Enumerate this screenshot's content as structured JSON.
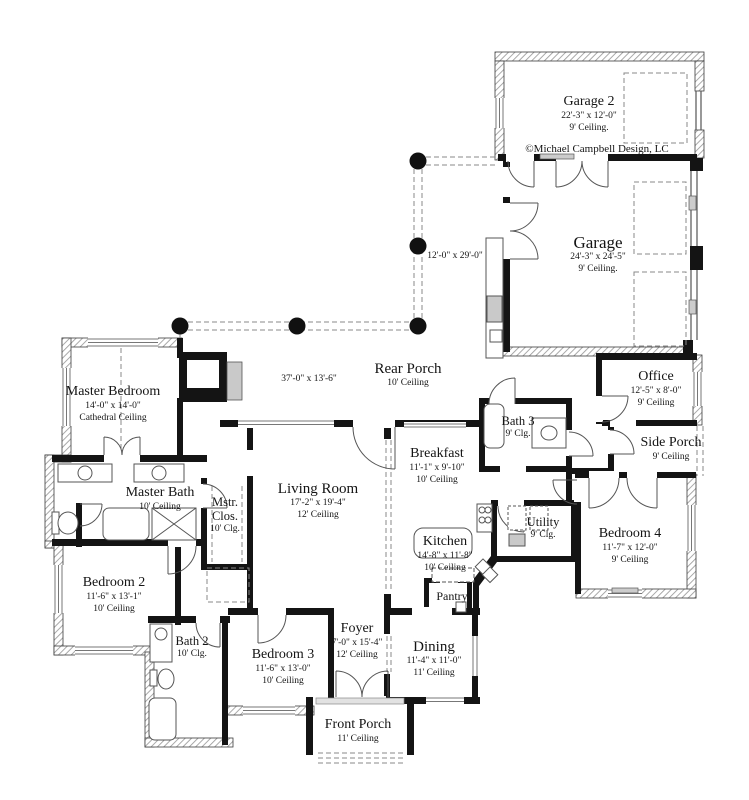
{
  "copyright": "©Michael Campbell Design, LC",
  "rooms": {
    "garage2": {
      "name": "Garage 2",
      "dims": "22'-3\" x 12'-0\"",
      "ceiling": "9' Ceiling."
    },
    "garage": {
      "name": "Garage",
      "dims": "24'-3\" x 24'-5\"",
      "ceiling": "9' Ceiling."
    },
    "rear_porch": {
      "name": "Rear Porch",
      "ceiling": "10' Ceiling"
    },
    "office": {
      "name": "Office",
      "dims": "12'-5\" x 8'-0\"",
      "ceiling": "9' Ceiling"
    },
    "side_porch": {
      "name": "Side Porch",
      "ceiling": "9' Ceiling"
    },
    "master_bedroom": {
      "name": "Master Bedroom",
      "dims": "14'-0\" x 14'-0\"",
      "ceiling": "Cathedral Ceiling"
    },
    "bath3": {
      "name": "Bath 3",
      "ceiling": "9' Clg."
    },
    "breakfast": {
      "name": "Breakfast",
      "dims": "11'-1\" x 9'-10\"",
      "ceiling": "10' Ceiling"
    },
    "master_bath": {
      "name": "Master Bath",
      "ceiling": "10' Ceiling"
    },
    "mstr_clos": {
      "name": "Mstr.",
      "name2": "Clos.",
      "ceiling": "10' Clg."
    },
    "living_room": {
      "name": "Living Room",
      "dims": "17'-2\" x 19'-4\"",
      "ceiling": "12' Ceiling"
    },
    "kitchen": {
      "name": "Kitchen",
      "dims": "14'-8\" x 11'-8\"",
      "ceiling": "10' Ceiling"
    },
    "utility": {
      "name": "Utility",
      "ceiling": "9' Clg."
    },
    "bedroom4": {
      "name": "Bedroom 4",
      "dims": "11'-7\" x 12'-0\"",
      "ceiling": "9' Ceiling"
    },
    "bedroom2": {
      "name": "Bedroom 2",
      "dims": "11'-6\" x 13'-1\"",
      "ceiling": "10' Ceiling"
    },
    "pantry": {
      "name": "Pantry"
    },
    "bath2": {
      "name": "Bath 2",
      "ceiling": "10' Clg."
    },
    "bedroom3": {
      "name": "Bedroom 3",
      "dims": "11'-6\" x 13'-0\"",
      "ceiling": "10' Ceiling"
    },
    "foyer": {
      "name": "Foyer",
      "dims": "7'-0\" x 15'-4\"",
      "ceiling": "12' Ceiling"
    },
    "dining": {
      "name": "Dining",
      "dims": "11'-4\" x 11'-0\"",
      "ceiling": "11' Ceiling"
    },
    "front_porch": {
      "name": "Front Porch",
      "ceiling": "11' Ceiling"
    }
  },
  "annotations": {
    "rear_porch_dim": "37'-0\" x 13'-6\"",
    "porch_run_dim": "12'-0\" x 29'-0\""
  },
  "colors": {
    "wall": "#141414",
    "paper": "#ffffff",
    "hatch_line": "#9a9a9a"
  }
}
